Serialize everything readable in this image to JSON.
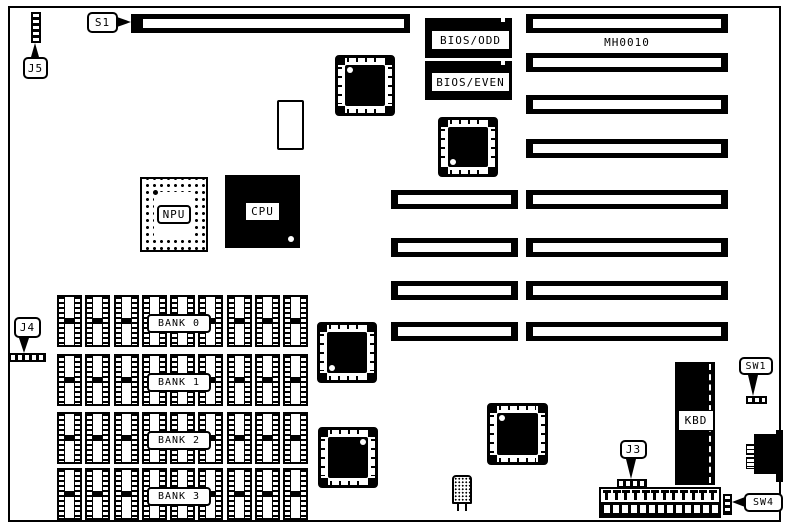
{
  "colors": {
    "ink": "#000000",
    "paper": "#ffffff"
  },
  "board": {
    "model_label": "MH0010"
  },
  "callouts": {
    "j5": "J5",
    "s1": "S1",
    "j4": "J4",
    "j3": "J3",
    "sw1": "SW1",
    "sw4": "SW4"
  },
  "chips": {
    "bios_odd": "BIOS/ODD",
    "bios_even": "BIOS/EVEN",
    "npu": "NPU",
    "cpu": "CPU",
    "kbd": "KBD"
  },
  "memory": {
    "banks": [
      {
        "label": "BANK 0"
      },
      {
        "label": "BANK 1"
      },
      {
        "label": "BANK 2"
      },
      {
        "label": "BANK 3"
      }
    ],
    "sockets_per_bank": 9
  },
  "power_connector": {
    "pin_count": 12
  }
}
